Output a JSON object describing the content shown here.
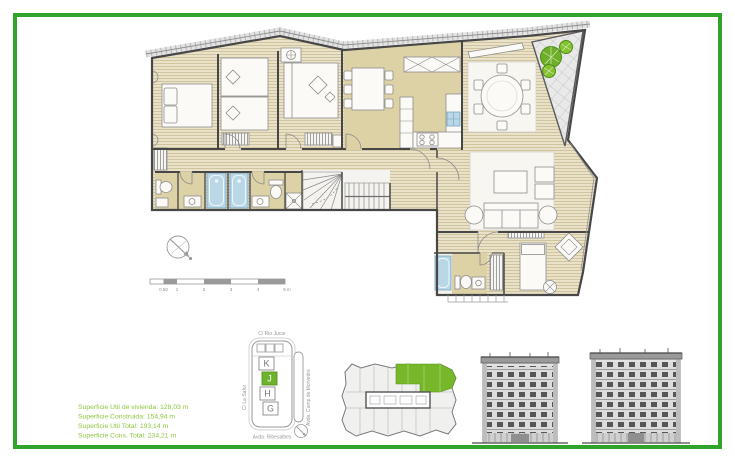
{
  "document": {
    "kind": "apartment floor plan sheet"
  },
  "surface_info": {
    "color": "#8dc63f",
    "lines": [
      "Superficie Util de vivienda: 128,03 m",
      "Superficie Construida: 154,94 m",
      "Superficie Util Total: 193,14 m",
      "Superficie Cons. Total: 234,21 m"
    ]
  },
  "scale_bar": {
    "labels": [
      "0.50",
      "1",
      "2",
      "3",
      "4",
      "5 m"
    ]
  },
  "key_plan": {
    "street_top": "C/ Rio Jucar",
    "street_left": "C/ La Safor",
    "street_right": "Avda. Camp de Morvedre",
    "street_bottom": "Avda. Ribesalbes",
    "blocks": [
      "K",
      "J",
      "H",
      "G"
    ],
    "highlighted_block": "J",
    "highlight_color": "#6db32b"
  },
  "colors": {
    "frame_green": "#2fa32a",
    "unit_highlight_green": "#76b82a",
    "wood_floor_tan": "#e9e1c6",
    "room_tan": "#ddd1a6",
    "water_blue": "#b9d7e6"
  }
}
